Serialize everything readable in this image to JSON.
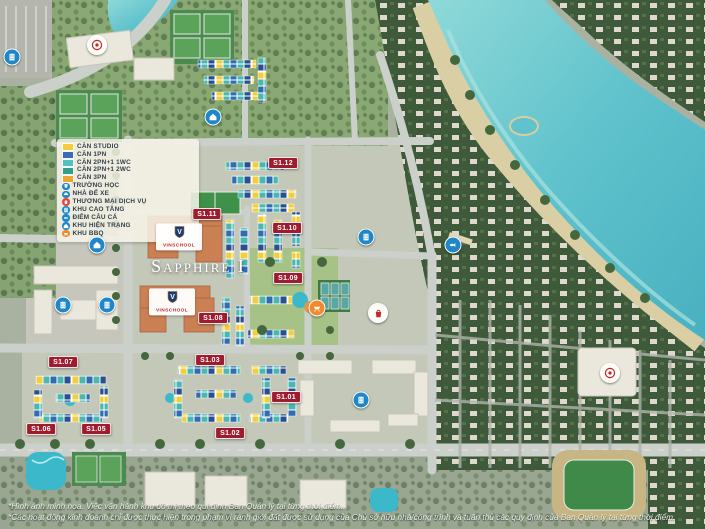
{
  "title": {
    "project": "Sapphire I"
  },
  "legend": {
    "items": [
      {
        "label": "CĂN STUDIO",
        "swatch": "#f2cf3a"
      },
      {
        "label": "CĂN 1PN",
        "swatch": "#3a6cb4"
      },
      {
        "label": "CĂN 2PN+1 1WC",
        "swatch": "#52bfc0"
      },
      {
        "label": "CĂN 2PN+1 2WC",
        "swatch": "#2fa08b"
      },
      {
        "label": "CĂN 3PN",
        "swatch": "#f0a62e"
      },
      {
        "label": "TRƯỜNG HỌC",
        "icon": "school-cap-icon",
        "color": "#1d87c9"
      },
      {
        "label": "NHÀ ĐỂ XE",
        "icon": "car-icon",
        "color": "#1d87c9"
      },
      {
        "label": "THƯƠNG MẠI DỊCH VỤ",
        "icon": "shopping-bag-icon",
        "color": "#e2483d"
      },
      {
        "label": "KHU CAO TẦNG",
        "icon": "high-rise-icon",
        "color": "#1d87c9"
      },
      {
        "label": "ĐIỂM CÂU CÁ",
        "icon": "fish-icon",
        "color": "#1d87c9"
      },
      {
        "label": "KHU HIỆN TRẠNG",
        "icon": "house-icon",
        "color": "#1d87c9"
      },
      {
        "label": "KHU BBQ",
        "icon": "bbq-grill-icon",
        "color": "#ef8b2d"
      }
    ]
  },
  "blocks": [
    {
      "id": "S1.12"
    },
    {
      "id": "S1.11"
    },
    {
      "id": "S1.10"
    },
    {
      "id": "S1.09"
    },
    {
      "id": "S1.08"
    },
    {
      "id": "S1.07"
    },
    {
      "id": "S1.06"
    },
    {
      "id": "S1.05"
    },
    {
      "id": "S1.03"
    },
    {
      "id": "S1.02"
    },
    {
      "id": "S1.01"
    }
  ],
  "school": {
    "name": "VINSCHOOL",
    "logo_letter": "V"
  },
  "poi_icons": [
    "house-icon",
    "high-rise-icon",
    "fish-icon",
    "shopping-bag-icon",
    "bbq-grill-icon",
    "project-seal-icon"
  ],
  "footnotes": {
    "line1": "*Hình ảnh minh họa. Việc vận hành khu đô thị theo qui định Ban Quản lý tại từng thời điểm.",
    "line2": "*Các hoạt động kinh doanh chỉ được thực hiện trong phạm vi ranh giới đất được sử dụng của Chủ sở hữu nhà/công trình và tuân thủ các quy định của Ban Quản lý tại từng thời điểm."
  }
}
